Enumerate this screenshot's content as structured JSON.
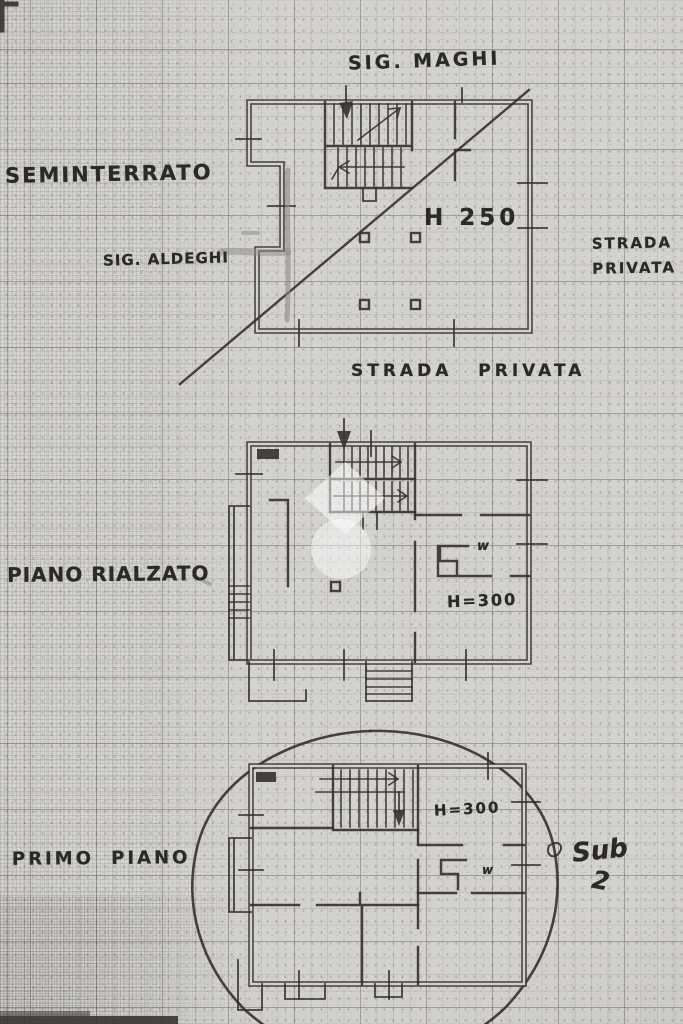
{
  "annotations": {
    "owner_name": "SIG. MAGHI",
    "neighbor_name": "SIG. ALDEGHI",
    "street_label_right": "STRADA PRIVATA",
    "street_label_bottom": "STRADA PRIVATA",
    "subunit_word": "Sub",
    "subunit_number": "2"
  },
  "floors": [
    {
      "label": "SEMINTERRATO",
      "ceiling_height": "H 250"
    },
    {
      "label": "PIANO RIALZATO",
      "ceiling_height": "H=300",
      "wc_mark": "w"
    },
    {
      "label": "PRIMO PIANO",
      "ceiling_height": "H=300",
      "wc_mark": "w"
    }
  ],
  "colors": {
    "paper": "#d4d2ce",
    "ink": "#34312d",
    "pencil": "#8d8b86"
  }
}
